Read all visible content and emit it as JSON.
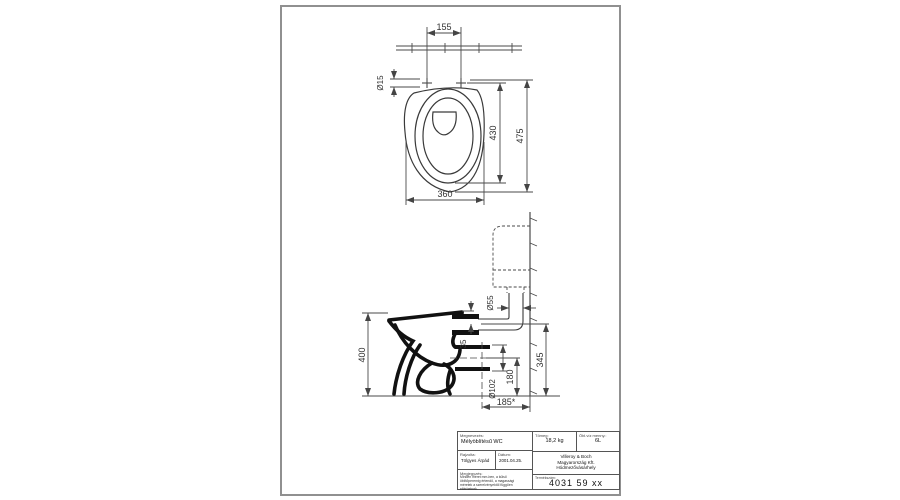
{
  "page": {
    "kind": "technical drawing",
    "colors": {
      "background": "#ffffff",
      "thin_line": "#4a4a4a",
      "section_line": "#111111",
      "frame": "#909090"
    }
  },
  "drawing": {
    "top_view": {
      "hole_spacing": "155",
      "hole_diameter": "Ø15",
      "bowl_inner_length": "430",
      "total_length": "475",
      "bowl_width": "360"
    },
    "side_view": {
      "total_height": "400",
      "flush_pipe_diameter": "Ø55",
      "rim_to_inlet": "35",
      "outlet_diameter": "Ø102",
      "outlet_height": "180",
      "inlet_height": "345",
      "outlet_wall_distance": "185*"
    }
  },
  "title_block": {
    "name_label": "Megnevezés:",
    "name_value": "Mélyöblítésű WC",
    "drawn_label": "Rajzolta:",
    "drawn_value": "Tölgyes Árpád",
    "date_label": "Dátum:",
    "date_value": "2001.04.25.",
    "note_label": "Megjegyzés:",
    "note_lines": [
      "Minden méret mm-ben, a külső",
      "öblítőperemig értendő, a magassági",
      "méretek a szerelvényektől függően",
      "eltérhetnek."
    ],
    "weight_label": "Tömeg:",
    "weight_value": "18,2 kg",
    "flush_label": "Öbl.víz menny.:",
    "flush_value": "6L",
    "company_lines": [
      "Villeroy & Boch",
      "Magyarország Kft.",
      "Hódmezővásárhely"
    ],
    "product_label": "Termékszám:",
    "product_value": "4031 59 xx"
  }
}
